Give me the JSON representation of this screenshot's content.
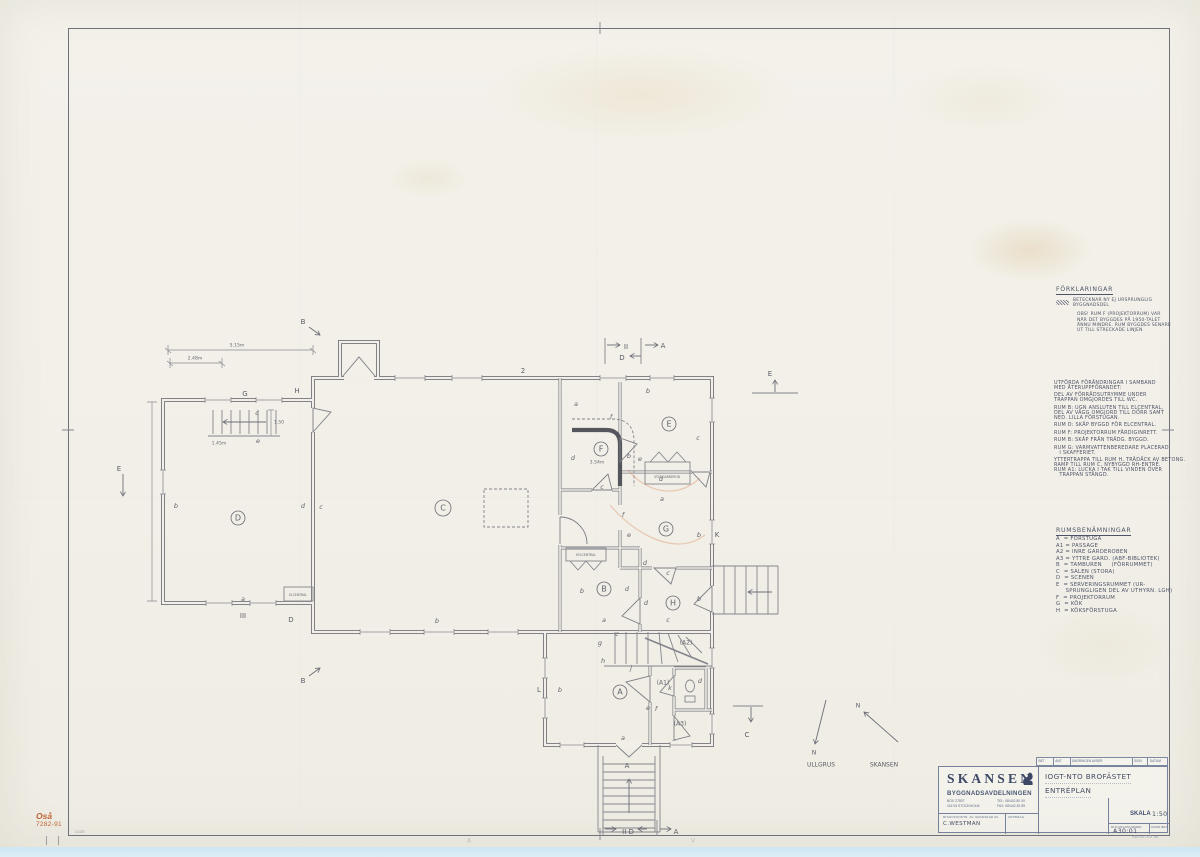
{
  "corner_stamp": {
    "line1": "Oså",
    "line2": "7282-91"
  },
  "notes": {
    "forklaringar": {
      "title": "FÖRKLARINGAR",
      "caption_lines": [
        "BETECKNAR NY EJ URSPRUNGLIG",
        "BYGGNADSDEL"
      ],
      "obs_lines": [
        "OBS! RUM F (PROJEKTORRUM) VAR",
        "NÄR DET BYGGDES PÅ 1950-TALET",
        "ÄNNU MINDRE. RUM BYGGDES SENARE",
        "UT TILL STRECKADE LINJEN"
      ]
    },
    "changes": {
      "lines": [
        "UTFÖRDA FÖRÄNDRINGAR I SAMBAND",
        "MED ÅTERUPPFÖRANDET:",
        "",
        "DEL AV FÖRRÅDSUTRYMME UNDER",
        "TRAPPAN OMGJORDES TILL WC.",
        "",
        "RUM B: UGN ANSLUTEN TILL ELCENTRAL,",
        "DEL AV VÄGG OMGJORD TILL DÖRR SAMT",
        "NED. LILLA FÖRSTUGAN.",
        "",
        "RUM D: SKÅP BYGGD FÖR ELCENTRAL.",
        "",
        "RUM F: PROJEKTORRUM FÄRDIGINRETT.",
        "",
        "RUM B: SKÅP FRÅN TRÄDG. BYGGD.",
        "",
        "RUM G: VARMVATTENBEREDARE PLACERAD",
        "   I SKAFFERIET.",
        "",
        "YTTERTRAPPA TILL RUM H, TRÄDÄCK AV BETONG.",
        "RAMP TILL RUM C, NYBYGGD RH-ENTRÉ.",
        "RUM A1: LUCKA I TAK TILL VINDEN ÖVER",
        "   TRAPPAN STÄNGD."
      ]
    },
    "room_legend": {
      "title": "RUMSBENÄMNINGAR",
      "lines": [
        "A  = FÖRSTUGA",
        "A1 = PASSAGE",
        "A2 = INRE GARDEROBEN",
        "A3 = YTTRE GARD. (ABF-BIBLIOTEK)",
        "B  = TAMBUREN     (FÖRRUMMET)",
        "C  = SALEN (STORA)",
        "D  = SCENEN",
        "E  = SERVERINGSRUMMET (UR-",
        "     SPRUNGLIGEN DEL AV UTHYRN. LGH)",
        "F  = PROJEKTORRUM",
        "G  = KÖK",
        "H  = KÖKSFÖRSTUGA"
      ]
    }
  },
  "plan": {
    "rooms": [
      [
        "D",
        238,
        518
      ],
      [
        "C",
        443,
        508
      ],
      [
        "F",
        601,
        449
      ],
      [
        "E",
        669,
        424
      ],
      [
        "G",
        666,
        529
      ],
      [
        "B",
        604,
        589
      ],
      [
        "H",
        673,
        603
      ],
      [
        "A",
        620,
        692
      ]
    ],
    "sub_rooms": [
      [
        "(A1)",
        663,
        683
      ],
      [
        "(A2)",
        686,
        643
      ],
      [
        "(A3)",
        680,
        724
      ]
    ],
    "tags": [
      [
        "b",
        176,
        506
      ],
      [
        "c",
        257,
        413
      ],
      [
        "e",
        258,
        441
      ],
      [
        "a",
        243,
        599
      ],
      [
        "d",
        303,
        506
      ],
      [
        "c",
        321,
        507
      ],
      [
        "b",
        437,
        621
      ],
      [
        "b",
        648,
        391
      ],
      [
        "a",
        576,
        404
      ],
      [
        "f",
        611,
        417
      ],
      [
        "d",
        573,
        458
      ],
      [
        "b",
        629,
        456
      ],
      [
        "e",
        640,
        459
      ],
      [
        "c",
        698,
        438
      ],
      [
        "d",
        661,
        479
      ],
      [
        "a",
        662,
        499
      ],
      [
        "c",
        602,
        487
      ],
      [
        "f",
        623,
        515
      ],
      [
        "e",
        629,
        535
      ],
      [
        "b",
        699,
        535
      ],
      [
        "d",
        645,
        563
      ],
      [
        "c",
        668,
        573
      ],
      [
        "b",
        582,
        591
      ],
      [
        "d",
        627,
        589
      ],
      [
        "d",
        646,
        603
      ],
      [
        "b",
        699,
        599
      ],
      [
        "k",
        670,
        688
      ],
      [
        "d",
        700,
        681
      ],
      [
        "e",
        648,
        708
      ],
      [
        "f",
        656,
        709
      ],
      [
        "a",
        623,
        738
      ],
      [
        "b",
        560,
        690
      ],
      [
        "g",
        600,
        643
      ],
      [
        "c",
        617,
        634
      ],
      [
        "h",
        603,
        661
      ],
      [
        "j",
        631,
        668
      ],
      [
        "c",
        668,
        620
      ],
      [
        "a",
        604,
        620
      ]
    ],
    "markers": [
      [
        "B",
        303,
        322
      ],
      [
        "B",
        303,
        681
      ],
      [
        "E",
        119,
        469
      ],
      [
        "II",
        626,
        347
      ],
      [
        "A",
        663,
        346
      ],
      [
        "D",
        622,
        358
      ],
      [
        "E",
        770,
        374
      ],
      [
        "K",
        717,
        535
      ],
      [
        "L",
        539,
        690
      ],
      [
        "C",
        747,
        735
      ],
      [
        "A",
        627,
        766
      ],
      [
        "G",
        245,
        394
      ],
      [
        "H",
        297,
        391
      ],
      [
        "III",
        243,
        616
      ],
      [
        "D",
        291,
        620
      ],
      [
        "II D",
        628,
        832
      ],
      [
        "A",
        676,
        832
      ],
      [
        "2",
        523,
        371
      ]
    ],
    "dims": [
      [
        "5.15m",
        237,
        346
      ],
      [
        "2.48m",
        195,
        359
      ],
      [
        "1.45m",
        219,
        444
      ],
      [
        "1.50",
        279,
        423
      ],
      [
        "3.54m",
        597,
        463
      ]
    ],
    "box_labels": [
      [
        "ELCENTRAL",
        298,
        595
      ],
      [
        "KYLCENTRAL",
        586,
        555
      ],
      [
        "STÄDGARDEROB",
        667,
        477
      ]
    ],
    "north": [
      [
        "N",
        814,
        753
      ],
      [
        "N",
        858,
        706
      ]
    ],
    "north_labels": [
      [
        "ULLGRUS",
        821,
        765
      ],
      [
        "SKANSEN",
        884,
        765
      ]
    ],
    "edge_marks": [
      [
        "A",
        469,
        841
      ],
      [
        "V",
        693,
        841
      ]
    ],
    "micro_number": "211387"
  },
  "titleblock": {
    "revision_headers": [
      "BET",
      "ANT",
      "ÄNDRINGEN AVSER",
      "SIGN",
      "DATUM"
    ],
    "org_name": "SKANSEN",
    "dept": "BYGGNADSAVDELNINGEN",
    "address1": "BOX 27807",
    "address2": "115 93 STOCKHOLM",
    "tel": "TEL: 08/442 80 00",
    "fax": "FAX: 08/442 82 89",
    "label_drawn": "RITAD/KONSTR. AV",
    "label_checked": "GRANSKAD AV",
    "label_uppdrag": "UPPDRAG",
    "drawn_by": "C.WESTMAN",
    "title_line1": "IOGT-NTO   BROFÄSTET",
    "title_line2": "ENTRÉPLAN",
    "scale_label": "SKALA",
    "scale_value": "1:50",
    "number_label": "RITNINGSNUMMER",
    "number_value": "A30:01",
    "andr_label": "ÄNDR.BET",
    "brand_note": "VELVETEX 98"
  }
}
